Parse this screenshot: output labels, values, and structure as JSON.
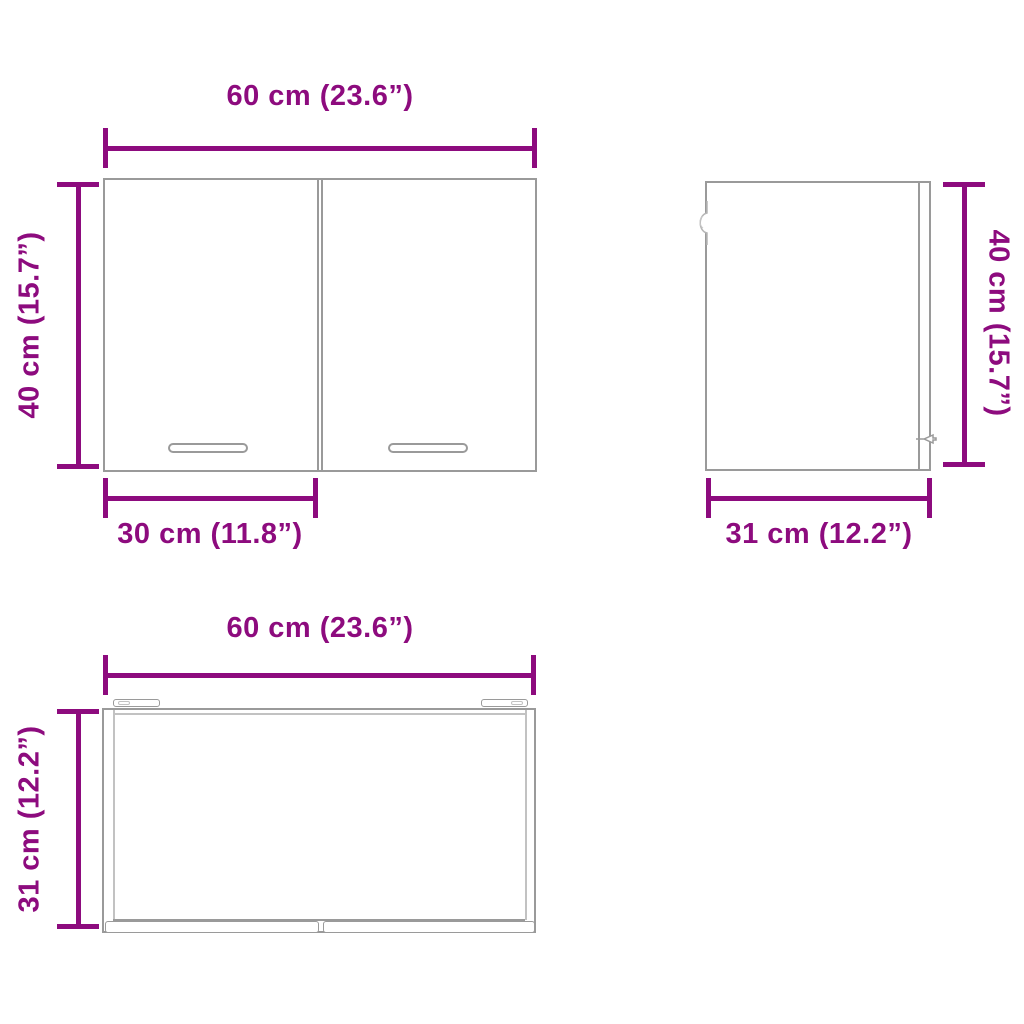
{
  "colors": {
    "dimension": "#8D0B7E",
    "outline": "#9a9a9a",
    "outline-light": "#c2c2c2",
    "background": "#ffffff"
  },
  "diagram": {
    "subject": "wall-cabinet-dimension-diagram",
    "front_view": {
      "width_label": "60 cm (23.6”)",
      "height_label": "40 cm (15.7”)",
      "door_width_label": "30 cm (11.8”)"
    },
    "side_view": {
      "height_label": "40 cm (15.7”)",
      "depth_label": "31 cm (12.2”)"
    },
    "top_view": {
      "width_label": "60 cm (23.6”)",
      "depth_label": "31 cm (12.2”)"
    }
  }
}
